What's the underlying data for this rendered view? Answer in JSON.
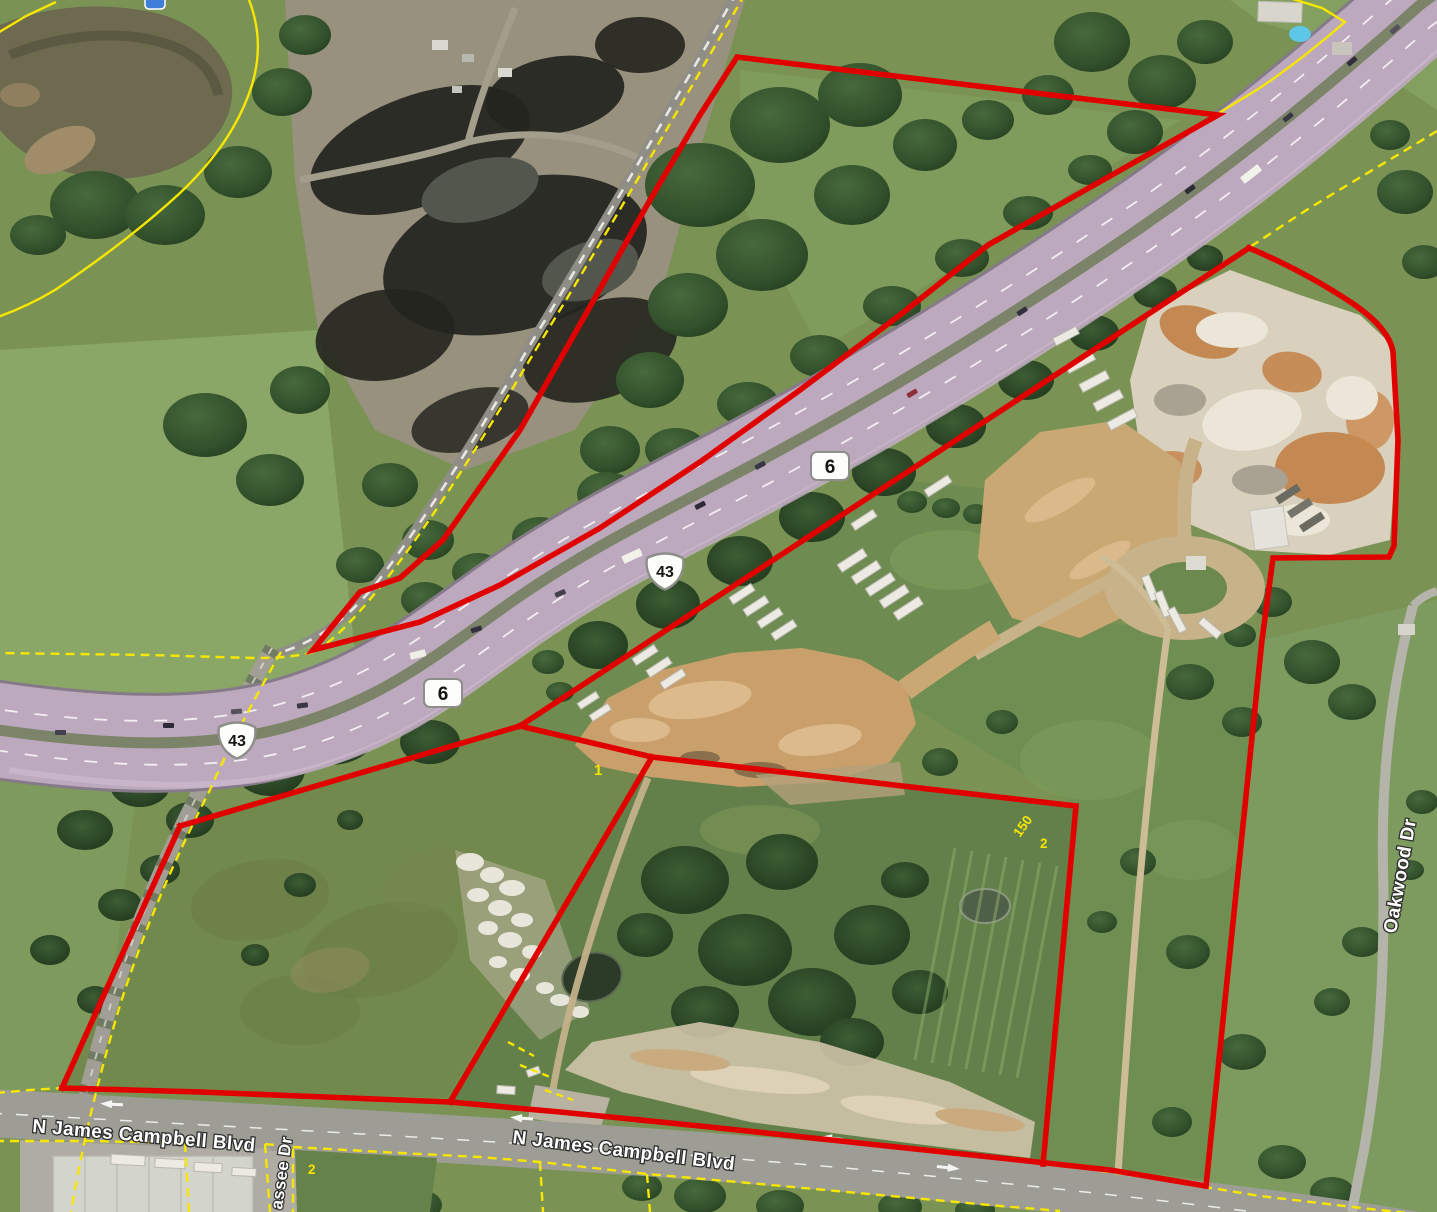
{
  "map": {
    "type": "satellite-parcel-map",
    "route_shields": [
      {
        "id": "state-6-upper",
        "system": "state",
        "label": "6"
      },
      {
        "id": "us-43-upper",
        "system": "us",
        "label": "43"
      },
      {
        "id": "state-6-lower",
        "system": "state",
        "label": "6"
      },
      {
        "id": "us-43-lower",
        "system": "us",
        "label": "43"
      }
    ],
    "street_labels": {
      "james_campbell_west": "N James Campbell Blvd",
      "james_campbell_east": "N James Campbell Blvd",
      "oakwood": "Oakwood Dr",
      "hiwassee_partial": "assee Dr"
    },
    "parcel_annotations": {
      "lot_1": "1",
      "dim_150": "150",
      "lot_2_east": "2",
      "lot_2_south": "2"
    },
    "colors": {
      "subject_boundary_red": "#e10000",
      "parcel_line_yellow": "#f7e600",
      "highway_pavement": "#bda9bd",
      "water": "#6e6a4f"
    }
  }
}
